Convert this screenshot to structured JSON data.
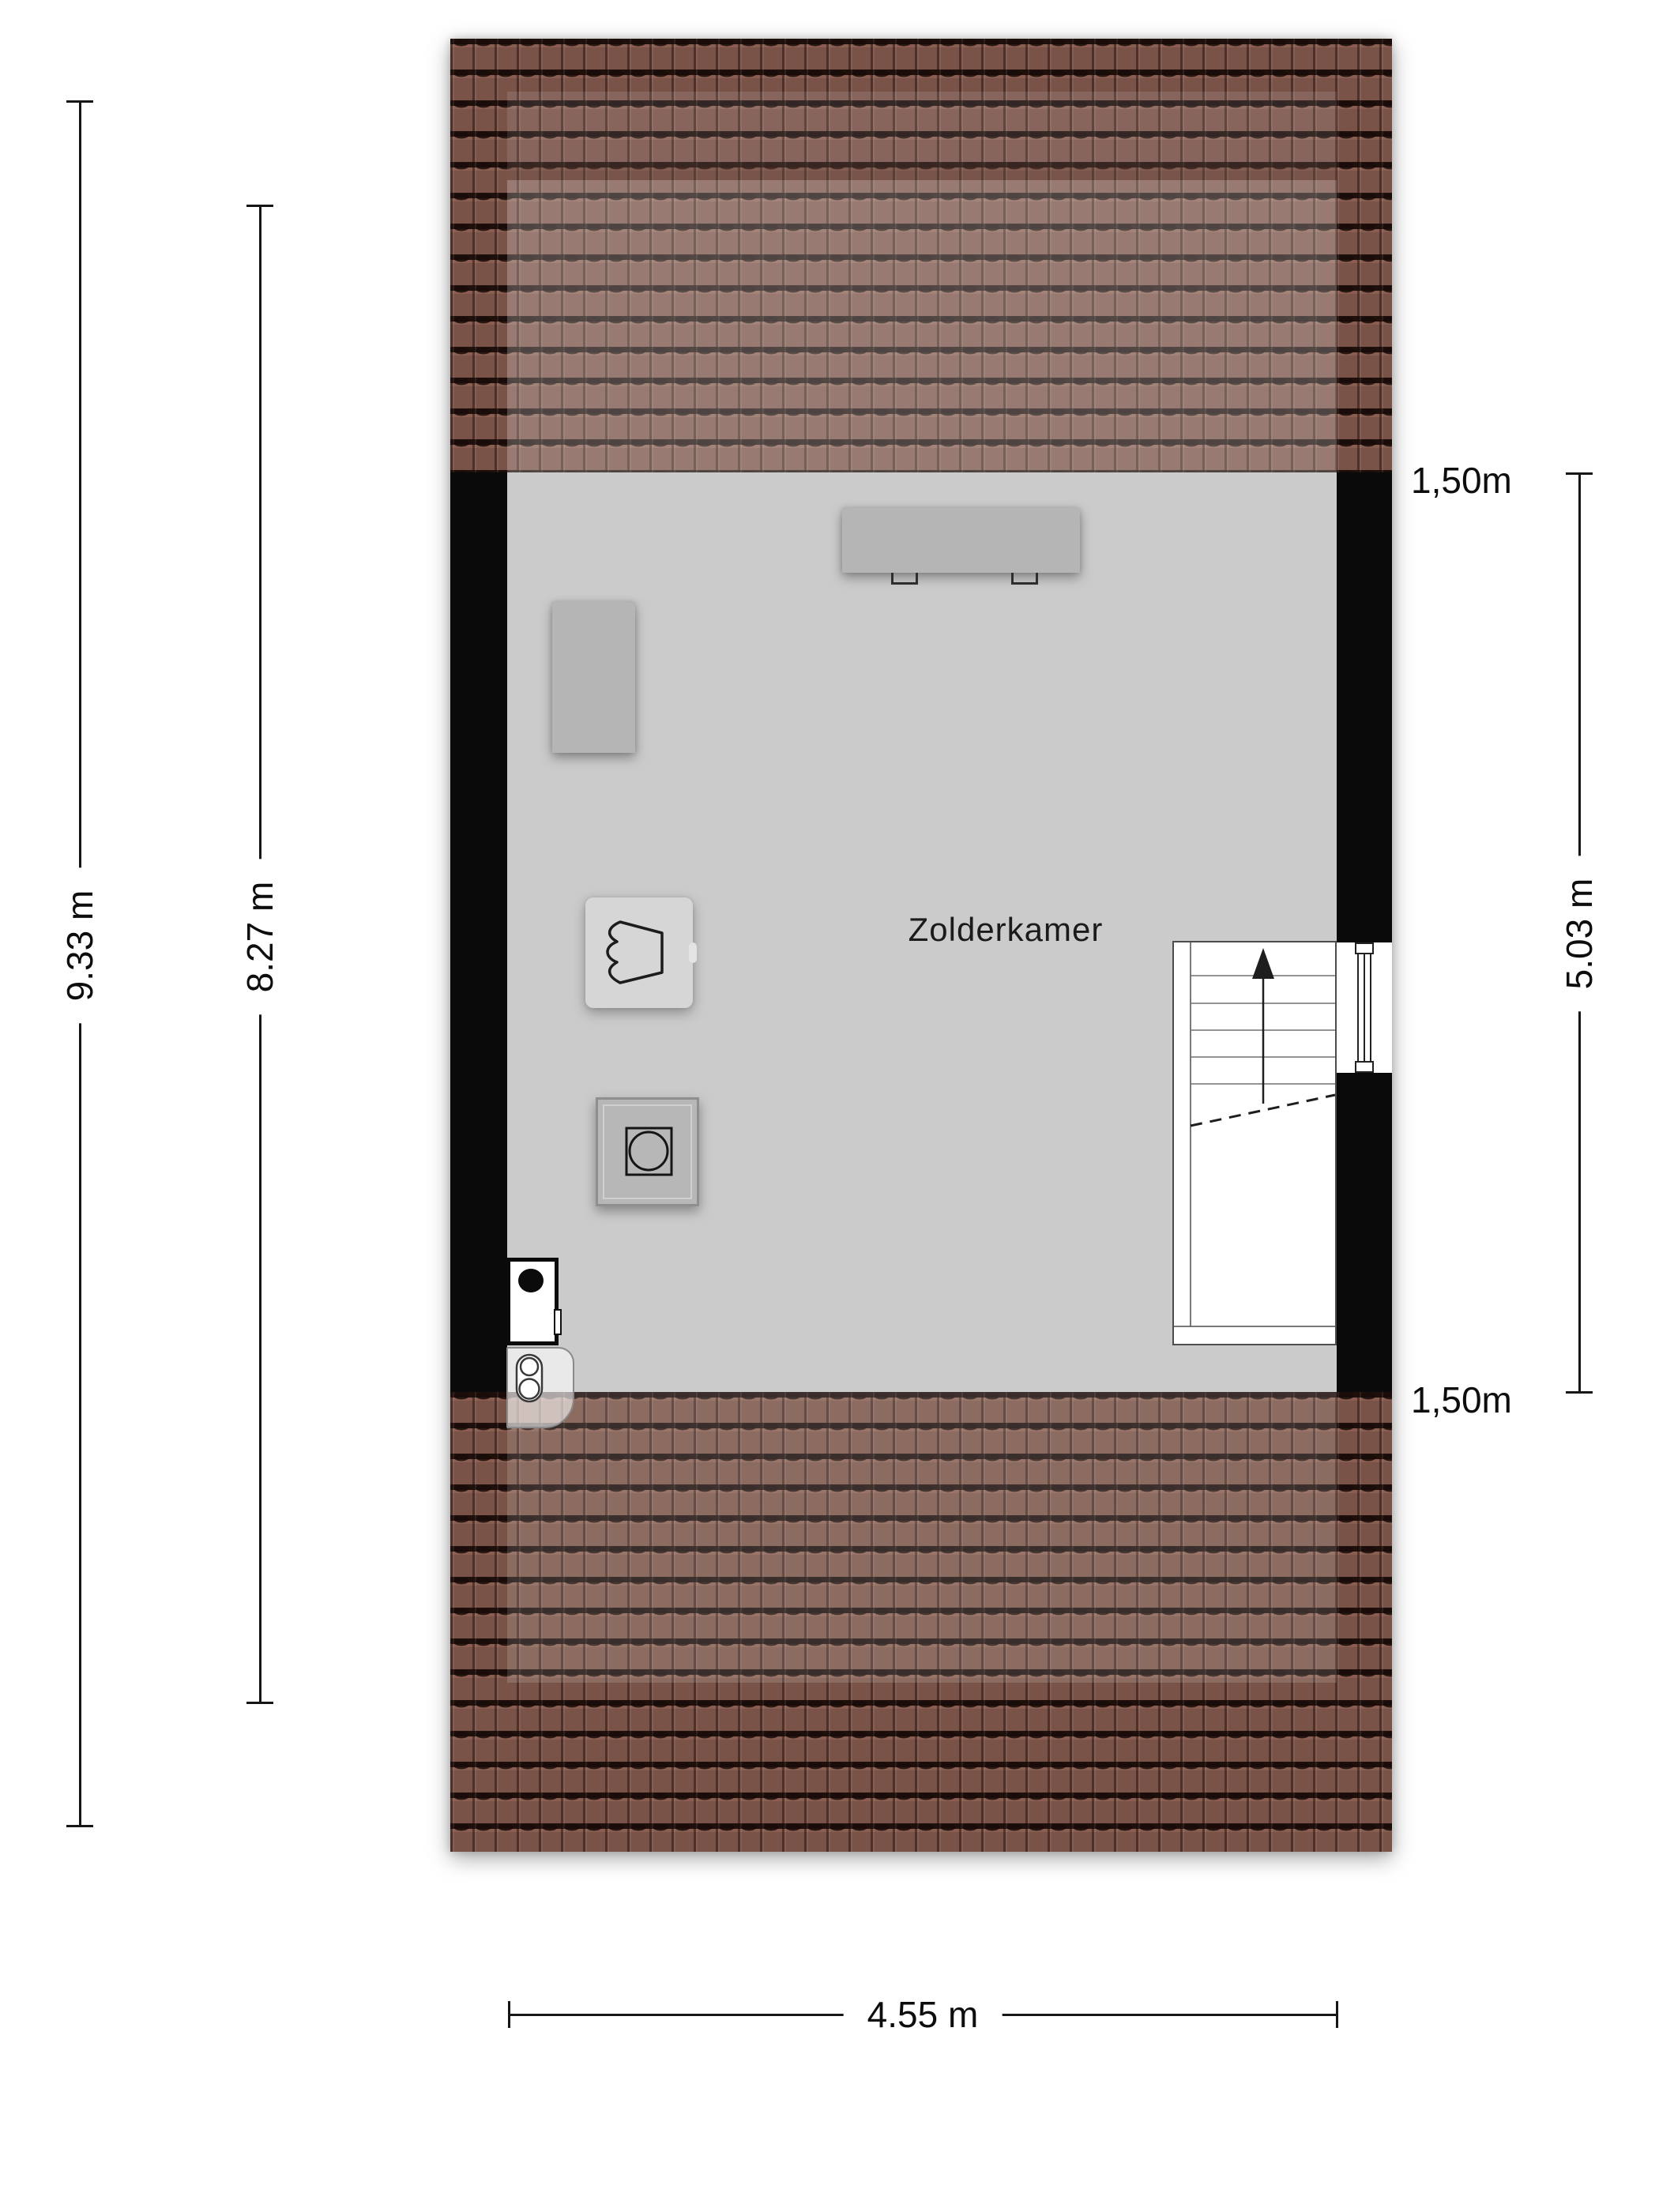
{
  "fp": {
    "room_label": "Zolderkamer",
    "dims": {
      "left_outer": "9.33 m",
      "left_inner": "8.27 m",
      "right": "5.03 m",
      "bottom": "4.55 m",
      "knee_top": "1,50m",
      "knee_bottom": "1,50m"
    },
    "features": {
      "stairs": "stairs up",
      "window": "window in right wall",
      "furniture": [
        "table",
        "wardrobe",
        "armchair",
        "washing-machine",
        "boiler",
        "ventilation-unit"
      ]
    },
    "colors": {
      "roof_tile": "#7a5348",
      "roof_gap": "#1a0c09",
      "wall": "#0a0a0a",
      "floor": "#cbcbcb",
      "furniture_gray": "#b5b5b5",
      "text": "#0d0d0d"
    }
  }
}
